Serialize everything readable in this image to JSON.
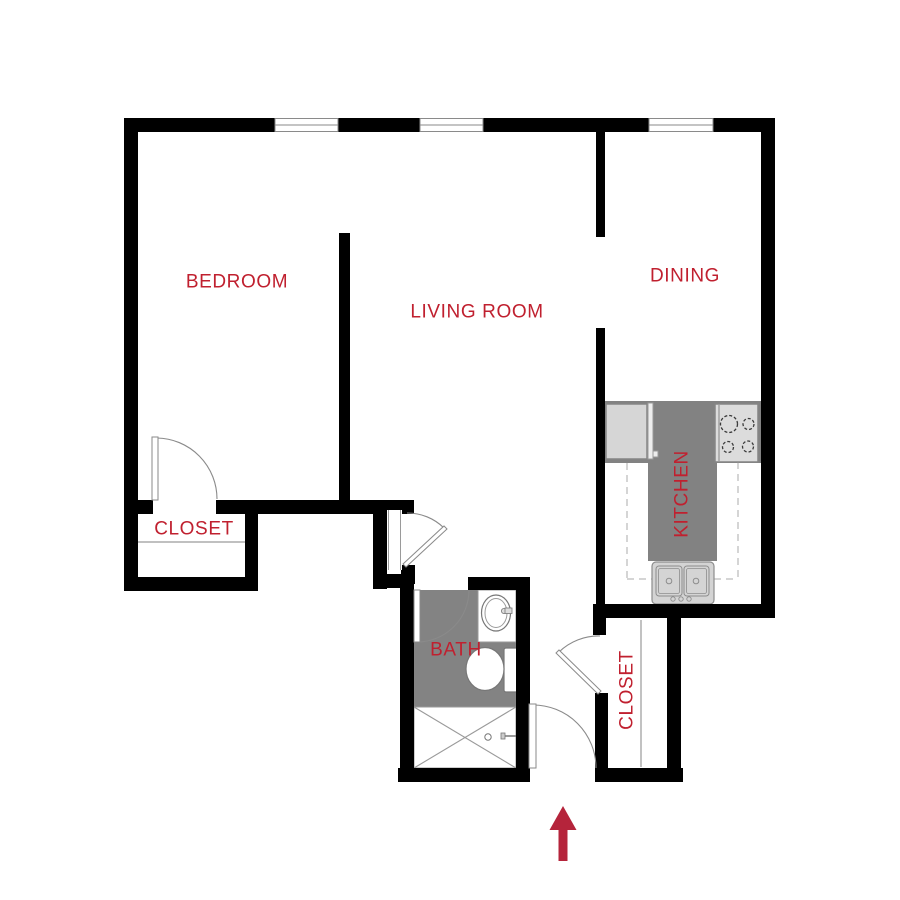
{
  "page": {
    "background": "#ffffff",
    "type": "apartment floor plan"
  },
  "colors": {
    "label": "#c0202f",
    "arrow": "#b5243b",
    "wall": "#000000",
    "counter": "#828282",
    "bath_floor": "#838383"
  },
  "rooms": {
    "bedroom": {
      "label": "BEDROOM"
    },
    "living_room": {
      "label": "LIVING ROOM"
    },
    "dining": {
      "label": "DINING"
    },
    "kitchen": {
      "label": "KITCHEN"
    },
    "bath": {
      "label": "BATH"
    },
    "closet_bedroom": {
      "label": "CLOSET"
    },
    "closet_entry": {
      "label": "CLOSET"
    }
  },
  "fixtures": {
    "windows": [
      "window",
      "window",
      "window"
    ],
    "kitchen": [
      "refrigerator",
      "cooktop-4-burners",
      "double-basin-sink",
      "counter-peninsula"
    ],
    "bath": [
      "vanity-sink",
      "toilet",
      "shower-stall"
    ],
    "doors": [
      "bedroom-door",
      "hall-door",
      "bath-door",
      "entry-door",
      "closet-door"
    ],
    "entry_marker": "up-arrow"
  }
}
